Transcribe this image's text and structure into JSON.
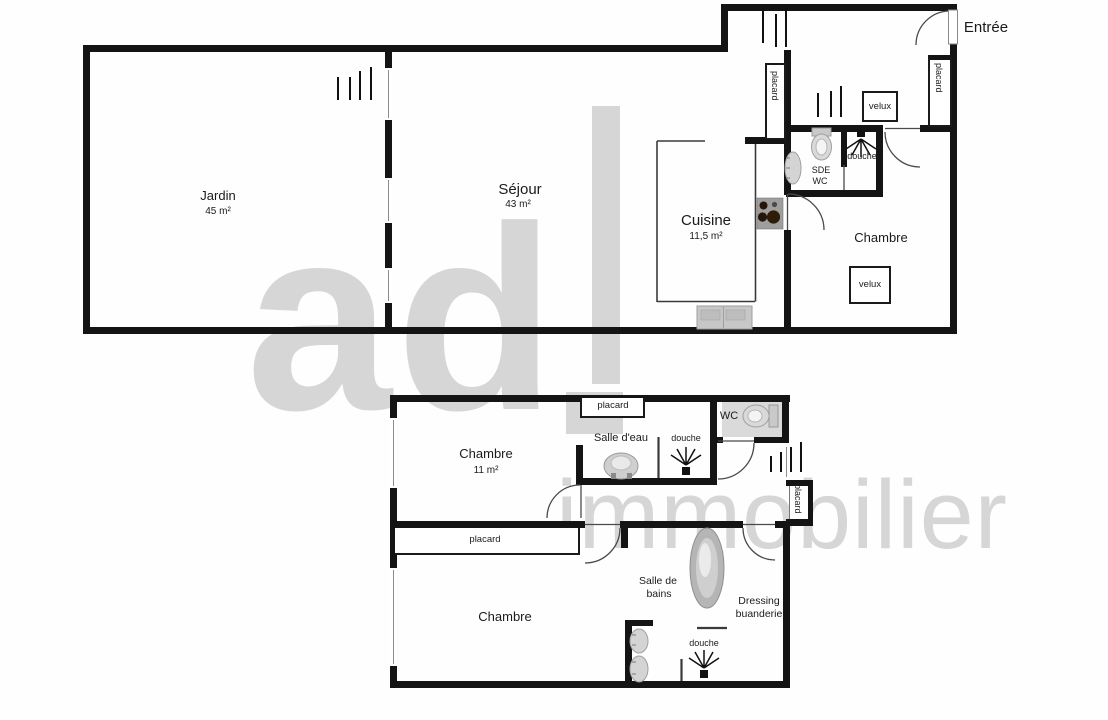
{
  "watermark": {
    "logo": "ad",
    "name": "immobilier"
  },
  "colors": {
    "walls": "#141414",
    "watermark": "#d6d6d6",
    "fixtures": "#c9c9c9",
    "background": "#ffffff"
  },
  "floor1": {
    "entree": "Entrée",
    "jardin_name": "Jardin",
    "jardin_area": "45 m²",
    "sejour_name": "Séjour",
    "sejour_area": "43 m²",
    "cuisine_name": "Cuisine",
    "cuisine_area": "11,5 m²",
    "chambre_name": "Chambre",
    "sde_line1": "SDE",
    "sde_line2": "WC",
    "douche": "douche",
    "velux_entree": "velux",
    "velux_chambre": "velux",
    "placard_left": "placard",
    "placard_right": "placard"
  },
  "floor2": {
    "chambre1_name": "Chambre",
    "chambre1_area": "11 m²",
    "chambre2_name": "Chambre",
    "salle_eau": "Salle d'eau",
    "salle_bains_line1": "Salle de",
    "salle_bains_line2": "bains",
    "dressing_line1": "Dressing",
    "dressing_line2": "buanderie",
    "wc": "WC",
    "douche_haut": "douche",
    "douche_bas": "douche",
    "placard_haut": "placard",
    "placard_milieu": "placard",
    "placard_droit": "placard"
  }
}
